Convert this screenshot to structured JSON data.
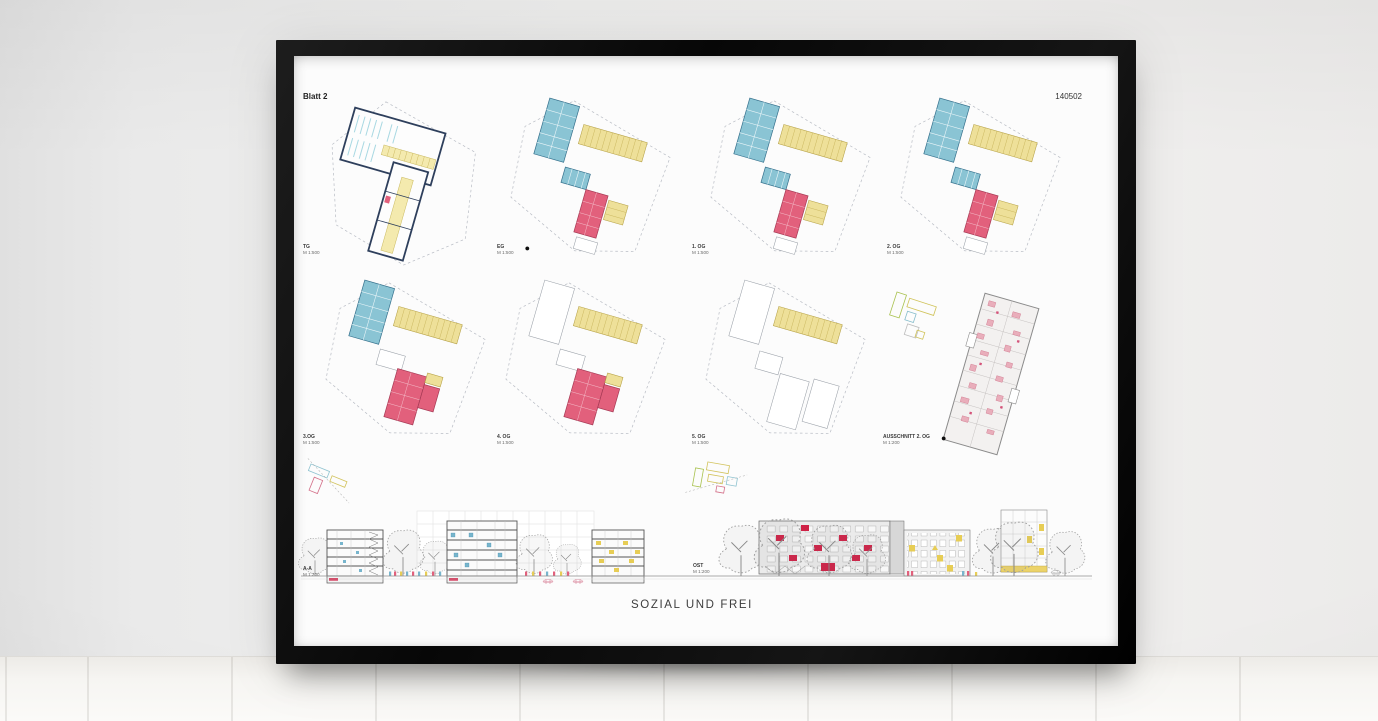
{
  "poster": {
    "sheet_label": "Blatt 2",
    "sheet_number": "140502",
    "title": "SOZIAL UND FREI",
    "plans": [
      {
        "label": "TG",
        "scale": "M 1:500"
      },
      {
        "label": "EG",
        "scale": "M 1:500"
      },
      {
        "label": "1. OG",
        "scale": "M 1:500"
      },
      {
        "label": "2. OG",
        "scale": "M 1:500"
      },
      {
        "label": "3.OG",
        "scale": "M 1:500"
      },
      {
        "label": "4. OG",
        "scale": "M 1:500"
      },
      {
        "label": "5. OG",
        "scale": "M 1:500"
      },
      {
        "label": "AUSSCHNITT 2. OG",
        "scale": "M 1:200"
      }
    ],
    "sections": [
      {
        "label": "A-A",
        "scale": "M 1:200"
      },
      {
        "label": "OST",
        "scale": "M 1:200"
      }
    ],
    "icons": {
      "north_arrow": "●"
    },
    "colors": {
      "plan_blue": "#8ac4d4",
      "plan_yellow": "#eee099",
      "plan_pink": "#e2607c",
      "plan_navy": "#2e3f5c",
      "elevation_red": "#cf2146",
      "frame": "#141414"
    }
  }
}
